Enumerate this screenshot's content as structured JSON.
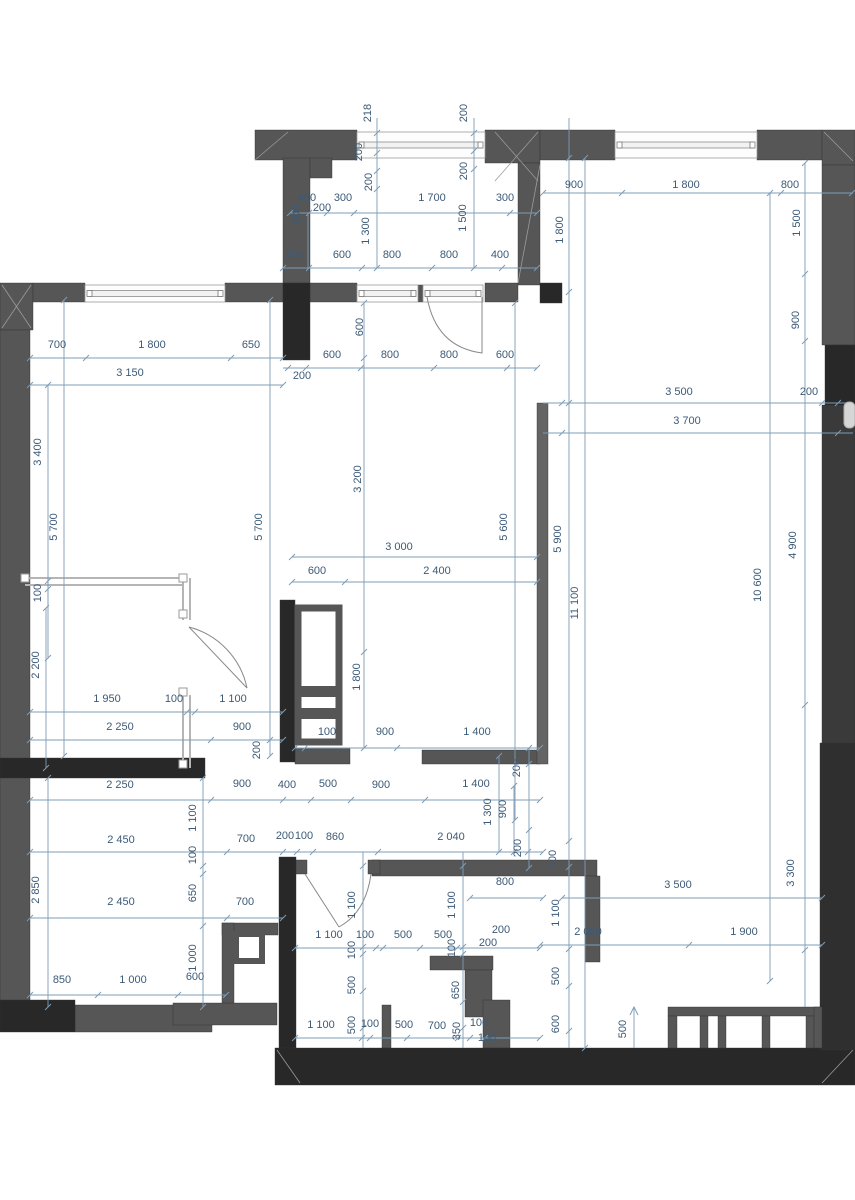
{
  "drawing": {
    "type": "architectural floor plan with dimension chains",
    "units": "millimeters",
    "colors": {
      "wall_gray": "#565656",
      "wall_black": "#282828",
      "dim_line": "#7e9cb6",
      "dim_text": "#3c5a77",
      "partition": "#c4c4c4",
      "background": "#ffffff"
    }
  },
  "dimension_labels": [
    {
      "t": "218",
      "x": 371,
      "y": 113,
      "v": 1
    },
    {
      "t": "200",
      "x": 467,
      "y": 113,
      "v": 1
    },
    {
      "t": "200",
      "x": 362,
      "y": 152,
      "v": 1
    },
    {
      "t": "200",
      "x": 372,
      "y": 182,
      "v": 1
    },
    {
      "t": "200",
      "x": 467,
      "y": 171,
      "v": 1
    },
    {
      "t": "1 500",
      "x": 300,
      "y": 219,
      "v": 1
    },
    {
      "t": "1 300",
      "x": 369,
      "y": 231,
      "v": 1
    },
    {
      "t": "1 500",
      "x": 466,
      "y": 218,
      "v": 1
    },
    {
      "t": "1 800",
      "x": 563,
      "y": 230,
      "v": 1
    },
    {
      "t": "400",
      "x": 307,
      "y": 201,
      "v": 0
    },
    {
      "t": "300",
      "x": 343,
      "y": 201,
      "v": 0
    },
    {
      "t": "1 700",
      "x": 432,
      "y": 201,
      "v": 0
    },
    {
      "t": "300",
      "x": 505,
      "y": 201,
      "v": 0
    },
    {
      "t": "200",
      "x": 322,
      "y": 211,
      "v": 0
    },
    {
      "t": "900",
      "x": 574,
      "y": 188,
      "v": 0
    },
    {
      "t": "1 800",
      "x": 686,
      "y": 188,
      "v": 0
    },
    {
      "t": "800",
      "x": 790,
      "y": 188,
      "v": 0
    },
    {
      "t": "1 500",
      "x": 800,
      "y": 223,
      "v": 1
    },
    {
      "t": "900",
      "x": 799,
      "y": 320,
      "v": 1
    },
    {
      "t": "300",
      "x": 295,
      "y": 258,
      "v": 0
    },
    {
      "t": "600",
      "x": 342,
      "y": 258,
      "v": 0
    },
    {
      "t": "800",
      "x": 392,
      "y": 258,
      "v": 0
    },
    {
      "t": "800",
      "x": 449,
      "y": 258,
      "v": 0
    },
    {
      "t": "400",
      "x": 500,
      "y": 258,
      "v": 0
    },
    {
      "t": "700",
      "x": 57,
      "y": 348,
      "v": 0
    },
    {
      "t": "1 800",
      "x": 152,
      "y": 348,
      "v": 0
    },
    {
      "t": "650",
      "x": 251,
      "y": 348,
      "v": 0
    },
    {
      "t": "3 150",
      "x": 130,
      "y": 376,
      "v": 0
    },
    {
      "t": "600",
      "x": 363,
      "y": 327,
      "v": 1
    },
    {
      "t": "600",
      "x": 332,
      "y": 358,
      "v": 0
    },
    {
      "t": "800",
      "x": 390,
      "y": 358,
      "v": 0
    },
    {
      "t": "800",
      "x": 449,
      "y": 358,
      "v": 0
    },
    {
      "t": "600",
      "x": 505,
      "y": 358,
      "v": 0
    },
    {
      "t": "200",
      "x": 302,
      "y": 379,
      "v": 0
    },
    {
      "t": "3 500",
      "x": 679,
      "y": 395,
      "v": 0
    },
    {
      "t": "200",
      "x": 809,
      "y": 395,
      "v": 0
    },
    {
      "t": "3 700",
      "x": 687,
      "y": 424,
      "v": 0
    },
    {
      "t": "3 400",
      "x": 41,
      "y": 452,
      "v": 1
    },
    {
      "t": "5 700",
      "x": 57,
      "y": 527,
      "v": 1
    },
    {
      "t": "5 700",
      "x": 262,
      "y": 527,
      "v": 1
    },
    {
      "t": "3 200",
      "x": 361,
      "y": 479,
      "v": 1
    },
    {
      "t": "5 600",
      "x": 507,
      "y": 527,
      "v": 1
    },
    {
      "t": "5 900",
      "x": 561,
      "y": 539,
      "v": 1
    },
    {
      "t": "11 100",
      "x": 578,
      "y": 603,
      "v": 1
    },
    {
      "t": "10 600",
      "x": 761,
      "y": 585,
      "v": 1
    },
    {
      "t": "4 900",
      "x": 796,
      "y": 545,
      "v": 1
    },
    {
      "t": "100",
      "x": 41,
      "y": 593,
      "v": 1
    },
    {
      "t": "3 000",
      "x": 399,
      "y": 550,
      "v": 0
    },
    {
      "t": "600",
      "x": 317,
      "y": 574,
      "v": 0
    },
    {
      "t": "2 400",
      "x": 437,
      "y": 574,
      "v": 0
    },
    {
      "t": "2 200",
      "x": 39,
      "y": 665,
      "v": 1
    },
    {
      "t": "1 800",
      "x": 360,
      "y": 677,
      "v": 1
    },
    {
      "t": "1 950",
      "x": 107,
      "y": 702,
      "v": 0
    },
    {
      "t": "100",
      "x": 174,
      "y": 702,
      "v": 0
    },
    {
      "t": "1 100",
      "x": 233,
      "y": 702,
      "v": 0
    },
    {
      "t": "2 250",
      "x": 120,
      "y": 730,
      "v": 0
    },
    {
      "t": "900",
      "x": 242,
      "y": 730,
      "v": 0
    },
    {
      "t": "200",
      "x": 260,
      "y": 750,
      "v": 1
    },
    {
      "t": "100",
      "x": 327,
      "y": 735,
      "v": 0
    },
    {
      "t": "900",
      "x": 385,
      "y": 735,
      "v": 0
    },
    {
      "t": "1 400",
      "x": 477,
      "y": 735,
      "v": 0
    },
    {
      "t": "200",
      "x": 520,
      "y": 768,
      "v": 1
    },
    {
      "t": "2 250",
      "x": 120,
      "y": 788,
      "v": 0
    },
    {
      "t": "900",
      "x": 242,
      "y": 787,
      "v": 0
    },
    {
      "t": "400",
      "x": 287,
      "y": 788,
      "v": 0
    },
    {
      "t": "500",
      "x": 328,
      "y": 787,
      "v": 0
    },
    {
      "t": "900",
      "x": 381,
      "y": 788,
      "v": 0
    },
    {
      "t": "1 400",
      "x": 476,
      "y": 787,
      "v": 0
    },
    {
      "t": "1 100",
      "x": 196,
      "y": 818,
      "v": 1
    },
    {
      "t": "1 300",
      "x": 491,
      "y": 812,
      "v": 1
    },
    {
      "t": "900",
      "x": 506,
      "y": 809,
      "v": 1
    },
    {
      "t": "2 450",
      "x": 121,
      "y": 843,
      "v": 0
    },
    {
      "t": "700",
      "x": 246,
      "y": 842,
      "v": 0
    },
    {
      "t": "200",
      "x": 285,
      "y": 839,
      "v": 0
    },
    {
      "t": "100",
      "x": 304,
      "y": 839,
      "v": 0
    },
    {
      "t": "860",
      "x": 335,
      "y": 840,
      "v": 0
    },
    {
      "t": "2 040",
      "x": 451,
      "y": 840,
      "v": 0
    },
    {
      "t": "200",
      "x": 521,
      "y": 848,
      "v": 1
    },
    {
      "t": "100",
      "x": 196,
      "y": 855,
      "v": 1
    },
    {
      "t": "2 850",
      "x": 39,
      "y": 890,
      "v": 1
    },
    {
      "t": "650",
      "x": 196,
      "y": 893,
      "v": 1
    },
    {
      "t": "300",
      "x": 556,
      "y": 859,
      "v": 1
    },
    {
      "t": "3 300",
      "x": 794,
      "y": 873,
      "v": 1
    },
    {
      "t": "800",
      "x": 505,
      "y": 885,
      "v": 0
    },
    {
      "t": "3 500",
      "x": 678,
      "y": 888,
      "v": 0
    },
    {
      "t": "2 450",
      "x": 121,
      "y": 905,
      "v": 0
    },
    {
      "t": "700",
      "x": 245,
      "y": 905,
      "v": 0
    },
    {
      "t": "1 100",
      "x": 355,
      "y": 905,
      "v": 1
    },
    {
      "t": "1 100",
      "x": 455,
      "y": 905,
      "v": 1
    },
    {
      "t": "1 100",
      "x": 559,
      "y": 913,
      "v": 1
    },
    {
      "t": "1 100",
      "x": 329,
      "y": 938,
      "v": 0
    },
    {
      "t": "100",
      "x": 365,
      "y": 938,
      "v": 0
    },
    {
      "t": "500",
      "x": 403,
      "y": 938,
      "v": 0
    },
    {
      "t": "500",
      "x": 443,
      "y": 938,
      "v": 0
    },
    {
      "t": "200",
      "x": 501,
      "y": 933,
      "v": 0
    },
    {
      "t": "200",
      "x": 488,
      "y": 946,
      "v": 0
    },
    {
      "t": "2 000",
      "x": 588,
      "y": 935,
      "v": 0
    },
    {
      "t": "1 900",
      "x": 744,
      "y": 935,
      "v": 0
    },
    {
      "t": "100",
      "x": 355,
      "y": 950,
      "v": 1
    },
    {
      "t": "100",
      "x": 455,
      "y": 948,
      "v": 1
    },
    {
      "t": "1 000",
      "x": 196,
      "y": 958,
      "v": 1
    },
    {
      "t": "500",
      "x": 355,
      "y": 985,
      "v": 1
    },
    {
      "t": "650",
      "x": 459,
      "y": 990,
      "v": 1
    },
    {
      "t": "500",
      "x": 559,
      "y": 976,
      "v": 1
    },
    {
      "t": "850",
      "x": 62,
      "y": 983,
      "v": 0
    },
    {
      "t": "1 000",
      "x": 133,
      "y": 983,
      "v": 0
    },
    {
      "t": "600",
      "x": 195,
      "y": 980,
      "v": 0
    },
    {
      "t": "500",
      "x": 355,
      "y": 1025,
      "v": 1
    },
    {
      "t": "600",
      "x": 559,
      "y": 1024,
      "v": 1
    },
    {
      "t": "500",
      "x": 626,
      "y": 1029,
      "v": 1
    },
    {
      "t": "1 100",
      "x": 321,
      "y": 1028,
      "v": 0
    },
    {
      "t": "100",
      "x": 370,
      "y": 1027,
      "v": 0
    },
    {
      "t": "500",
      "x": 404,
      "y": 1028,
      "v": 0
    },
    {
      "t": "700",
      "x": 437,
      "y": 1029,
      "v": 0
    },
    {
      "t": "350",
      "x": 460,
      "y": 1031,
      "v": 1
    },
    {
      "t": "100",
      "x": 479,
      "y": 1026,
      "v": 0
    },
    {
      "t": "100",
      "x": 487,
      "y": 1041,
      "v": 0
    }
  ]
}
